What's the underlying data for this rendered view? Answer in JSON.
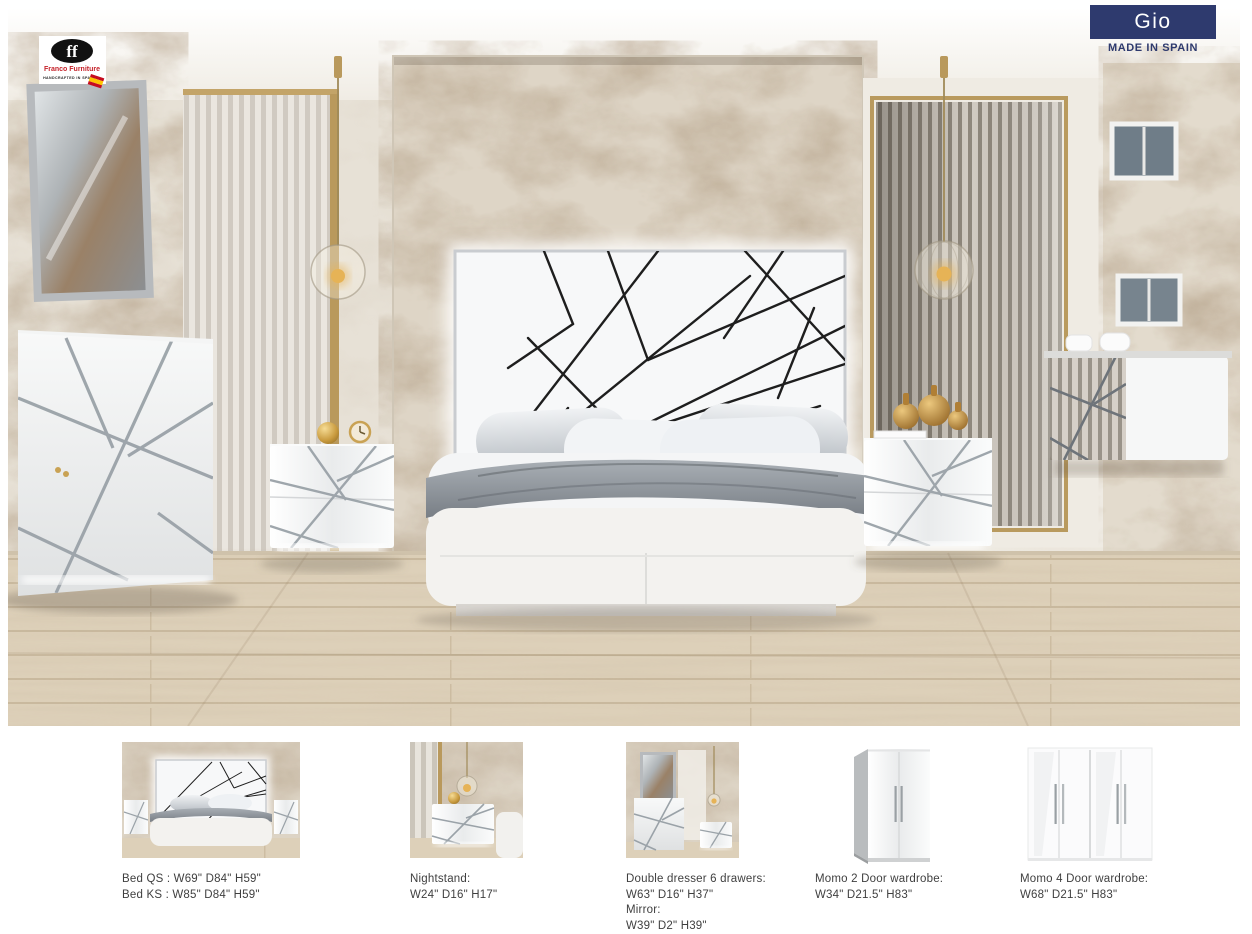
{
  "colors": {
    "banner_navy": "#2e3a6e",
    "logo_red": "#c5222a",
    "gold": "#b9995c",
    "chrome": "#98a0a6"
  },
  "brand": {
    "name": "Franco Furniture",
    "tagline": "HANDCRAFTED IN SPAIN",
    "monogram": "ff"
  },
  "header": {
    "collection": "Gio",
    "made_in": "MADE IN SPAIN"
  },
  "products": [
    {
      "caption_lines": [
        "Bed QS : W69\" D84\" H59\"",
        "Bed KS : W85\" D84\" H59\""
      ]
    },
    {
      "caption_lines": [
        "Nightstand:",
        "W24\" D16\" H17\""
      ]
    },
    {
      "caption_lines": [
        "Double dresser 6 drawers:",
        "W63\" D16\" H37\"",
        "Mirror:",
        "W39\" D2\" H39\""
      ]
    },
    {
      "caption_lines": [
        "Momo 2 Door wardrobe:",
        "W34\" D21.5\" H83\""
      ]
    },
    {
      "caption_lines": [
        "Momo 4 Door wardrobe:",
        "W68\" D21.5\" H83\""
      ]
    }
  ]
}
